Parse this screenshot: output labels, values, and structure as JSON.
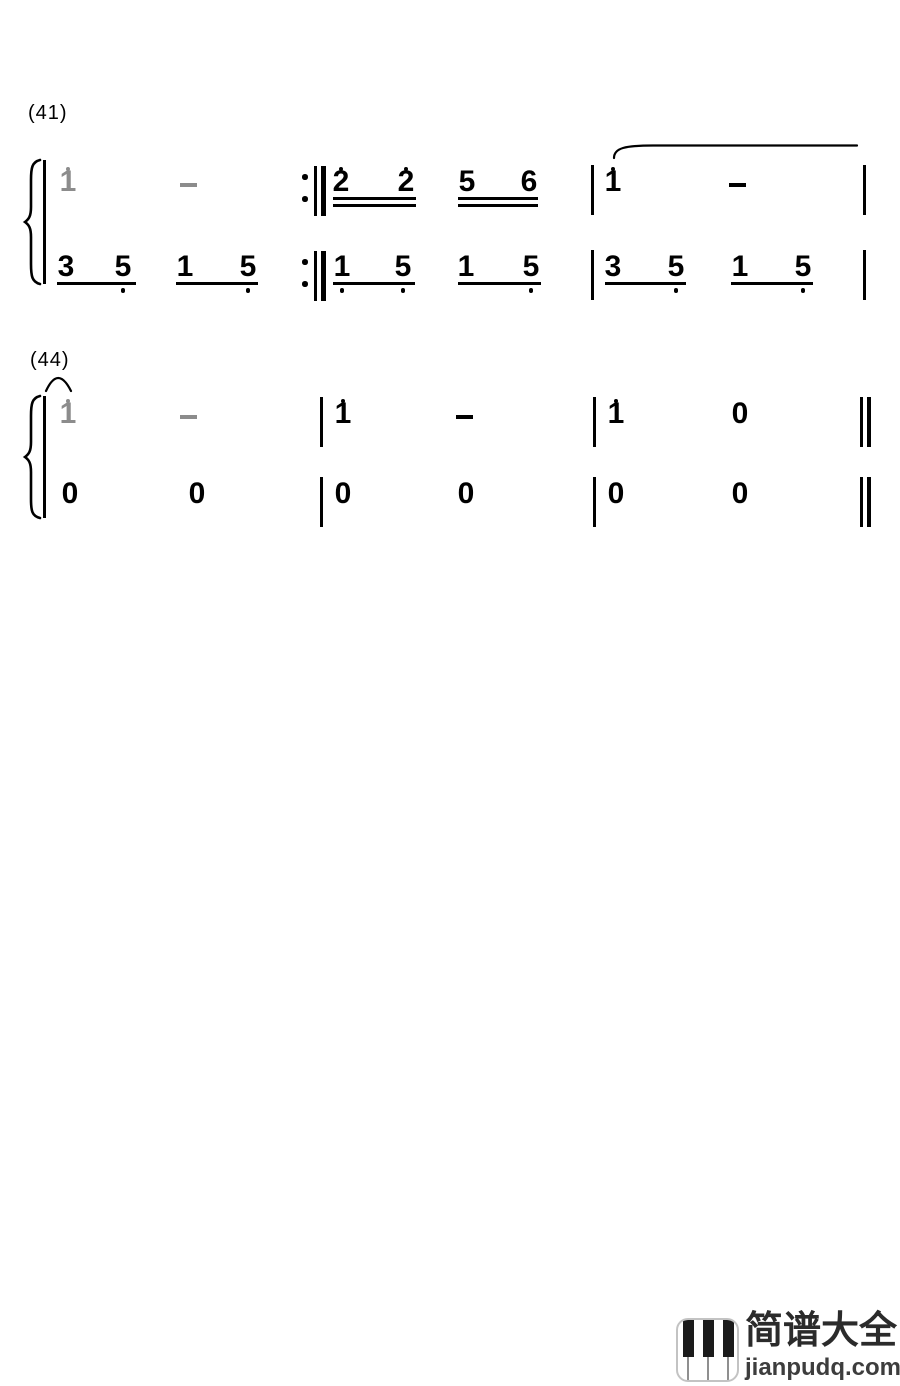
{
  "page": {
    "background": "#ffffff",
    "ink_color": "#000000",
    "tied_note_color": "#8c8c8c"
  },
  "systems": [
    {
      "label": "(41)",
      "label_pos": {
        "x": 28,
        "y": 101
      },
      "brace": {
        "x": 22,
        "y": 160,
        "h": 124,
        "path": "M40,160 C32,162 31,168 31,180 L31,207 C31,216 29,219 25,222 C29,225 31,228 31,237 L31,264 C31,276 32,282 40,284"
      },
      "rows": {
        "u": 168,
        "l": 253
      },
      "elements": [
        {
          "t": "note",
          "v": "1",
          "x": 68,
          "r": "u",
          "da": 1,
          "gray": true
        },
        {
          "t": "dash",
          "x": 188,
          "r": "u",
          "gray": true
        },
        {
          "t": "repeat",
          "x": 302,
          "r": "u"
        },
        {
          "t": "note",
          "v": "2",
          "x": 341,
          "r": "u",
          "da": 1
        },
        {
          "t": "note",
          "v": "2",
          "x": 406,
          "r": "u",
          "da": 1
        },
        {
          "t": "beam",
          "x1": 333,
          "x2": 416,
          "r": "u",
          "lines": 2
        },
        {
          "t": "note",
          "v": "5",
          "x": 467,
          "r": "u"
        },
        {
          "t": "note",
          "v": "6",
          "x": 529,
          "r": "u"
        },
        {
          "t": "beam",
          "x1": 458,
          "x2": 538,
          "r": "u",
          "lines": 2
        },
        {
          "t": "bar",
          "x": 591,
          "r": "u"
        },
        {
          "t": "note",
          "v": "1",
          "x": 613,
          "r": "u",
          "da": 1
        },
        {
          "t": "dash",
          "x": 737,
          "r": "u"
        },
        {
          "t": "bar",
          "x": 863,
          "r": "u"
        },
        {
          "t": "note",
          "v": "3",
          "x": 66,
          "r": "l"
        },
        {
          "t": "note",
          "v": "5",
          "x": 123,
          "r": "l",
          "db": 1
        },
        {
          "t": "beam",
          "x1": 57,
          "x2": 136,
          "r": "l",
          "lines": 1
        },
        {
          "t": "note",
          "v": "1",
          "x": 185,
          "r": "l"
        },
        {
          "t": "note",
          "v": "5",
          "x": 248,
          "r": "l",
          "db": 1
        },
        {
          "t": "beam",
          "x1": 176,
          "x2": 258,
          "r": "l",
          "lines": 1
        },
        {
          "t": "repeat",
          "x": 302,
          "r": "l"
        },
        {
          "t": "note",
          "v": "1",
          "x": 342,
          "r": "l",
          "db": 1
        },
        {
          "t": "note",
          "v": "5",
          "x": 403,
          "r": "l",
          "db": 1
        },
        {
          "t": "beam",
          "x1": 333,
          "x2": 415,
          "r": "l",
          "lines": 1
        },
        {
          "t": "note",
          "v": "1",
          "x": 466,
          "r": "l"
        },
        {
          "t": "note",
          "v": "5",
          "x": 531,
          "r": "l",
          "db": 1
        },
        {
          "t": "beam",
          "x1": 458,
          "x2": 541,
          "r": "l",
          "lines": 1
        },
        {
          "t": "bar",
          "x": 591,
          "r": "l"
        },
        {
          "t": "note",
          "v": "3",
          "x": 613,
          "r": "l"
        },
        {
          "t": "note",
          "v": "5",
          "x": 676,
          "r": "l",
          "db": 1
        },
        {
          "t": "beam",
          "x1": 605,
          "x2": 686,
          "r": "l",
          "lines": 1
        },
        {
          "t": "note",
          "v": "1",
          "x": 740,
          "r": "l"
        },
        {
          "t": "note",
          "v": "5",
          "x": 803,
          "r": "l",
          "db": 1
        },
        {
          "t": "beam",
          "x1": 731,
          "x2": 813,
          "r": "l",
          "lines": 1
        },
        {
          "t": "bar",
          "x": 863,
          "r": "l"
        }
      ]
    },
    {
      "label": "(44)",
      "label_pos": {
        "x": 30,
        "y": 348
      },
      "brace": {
        "x": 22,
        "y": 396,
        "h": 122,
        "path": "M40,396 C32,398 31,404 31,416 L31,442 C31,451 29,454 25,457 C29,460 31,463 31,472 L31,499 C31,511 32,516 40,518"
      },
      "rows": {
        "u": 400,
        "l": 480
      },
      "elements": [
        {
          "t": "note",
          "v": "1",
          "x": 68,
          "r": "u",
          "da": 1,
          "gray": true
        },
        {
          "t": "dash",
          "x": 188,
          "r": "u",
          "gray": true
        },
        {
          "t": "bar",
          "x": 320,
          "r": "u"
        },
        {
          "t": "note",
          "v": "1",
          "x": 343,
          "r": "u",
          "da": 1
        },
        {
          "t": "dash",
          "x": 464,
          "r": "u"
        },
        {
          "t": "bar",
          "x": 593,
          "r": "u"
        },
        {
          "t": "note",
          "v": "1",
          "x": 616,
          "r": "u",
          "da": 1
        },
        {
          "t": "note",
          "v": "0",
          "x": 740,
          "r": "u"
        },
        {
          "t": "final",
          "x": 860,
          "r": "u"
        },
        {
          "t": "note",
          "v": "0",
          "x": 70,
          "r": "l"
        },
        {
          "t": "note",
          "v": "0",
          "x": 197,
          "r": "l"
        },
        {
          "t": "bar",
          "x": 320,
          "r": "l"
        },
        {
          "t": "note",
          "v": "0",
          "x": 343,
          "r": "l"
        },
        {
          "t": "note",
          "v": "0",
          "x": 466,
          "r": "l"
        },
        {
          "t": "bar",
          "x": 593,
          "r": "l"
        },
        {
          "t": "note",
          "v": "0",
          "x": 616,
          "r": "l"
        },
        {
          "t": "note",
          "v": "0",
          "x": 740,
          "r": "l"
        },
        {
          "t": "final",
          "x": 860,
          "r": "l"
        }
      ]
    }
  ],
  "ties": [
    {
      "path": "M614,158 C614,148 625,145.5 653,145.5 L857,145.5"
    },
    {
      "path": "M46,391 Q58,365 71,391"
    }
  ],
  "watermark": {
    "brand": "简谱大全",
    "site": "jianpudq.com",
    "icon": "piano-keys-icon"
  }
}
